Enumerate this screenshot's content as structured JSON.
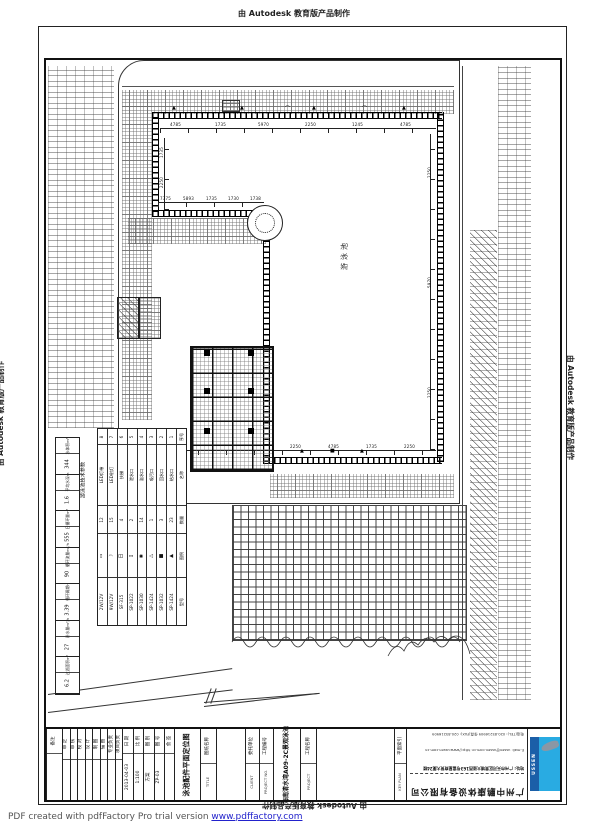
{
  "watermark": {
    "producer_top": "由 Autodesk 教育版产品制作",
    "producer_left": "由 Autodesk 教育版产品制作",
    "producer_right": "由 Autodesk 教育版产品制作",
    "producer_bottom": "由 Autodesk 教育版产品制作"
  },
  "footer": {
    "pdf_note": "PDF created with pdfFactory Pro trial version ",
    "pdf_link": "www.pdffactory.com"
  },
  "drawing": {
    "pool_label": "游泳池",
    "sym_triangle": "▲",
    "sym_square": "■",
    "sym_arc": "⌒",
    "top_dims": [
      "4785",
      "1735",
      "5970",
      "2250",
      "1245",
      "4785"
    ],
    "notch_dims": [
      "7375",
      "5893",
      "1735",
      "1730",
      "1738"
    ],
    "bottom_dims": [
      "2250",
      "4785",
      "1735",
      "2250"
    ],
    "left_dims": [
      "1735",
      "2250",
      "4785"
    ],
    "right_dims": [
      "2250",
      "5970",
      "2250"
    ]
  },
  "tech_table": {
    "title": "游泳池技术参数",
    "params": [
      {
        "label": "水体积m³",
        "value": "344"
      },
      {
        "label": "平均水深m",
        "value": "1.6"
      },
      {
        "label": "日循环量m³",
        "value": "555"
      },
      {
        "label": "循环流量m³/h",
        "value": "90"
      },
      {
        "label": "循环周期h",
        "value": "3.39"
      },
      {
        "label": "补水量m³/h",
        "value": "27"
      },
      {
        "label": "过滤面积m²",
        "value": "6.2"
      }
    ]
  },
  "legend": {
    "headers": {
      "no": "序号",
      "name": "名称",
      "qty": "数量",
      "symbol": "图例",
      "model": "型号"
    },
    "items": [
      {
        "no": "1",
        "name": "给水口",
        "qty": "23",
        "symbol": "▲",
        "model": "SP-1424"
      },
      {
        "no": "2",
        "name": "回水口",
        "qty": "3",
        "symbol": "■",
        "model": "SP-1032"
      },
      {
        "no": "3",
        "name": "吸污口",
        "qty": "1",
        "symbol": "△",
        "model": "SP-1424"
      },
      {
        "no": "4",
        "name": "溢水口",
        "qty": "14",
        "symbol": "◉",
        "model": "SP-1030"
      },
      {
        "no": "5",
        "name": "泄水口",
        "qty": "2",
        "symbol": "▯",
        "model": "SP-1022"
      },
      {
        "no": "6",
        "name": "扶梯",
        "qty": "4",
        "symbol": "日",
        "model": "SF-315"
      },
      {
        "no": "7",
        "name": "LED射灯",
        "qty": "15",
        "symbol": "☽",
        "model": "9W/12V"
      },
      {
        "no": "8",
        "name": "LED灯带",
        "qty": "12",
        "symbol": "▭",
        "model": "2W/12V"
      }
    ]
  },
  "title_block": {
    "note": "备注",
    "sign_cells": [
      "审 定",
      "审 核",
      "校 对",
      "设 计",
      "制 图",
      "描 图",
      "专业负责",
      "项目负责"
    ],
    "info_cells": [
      {
        "label": "日 期",
        "value": "2013-04-03"
      },
      {
        "label": "比 例",
        "value": "1:100"
      },
      {
        "label": "图 别",
        "value": "方案"
      },
      {
        "label": "图 号",
        "value": "ZP-03"
      },
      {
        "label": "会 签",
        "value": ""
      }
    ],
    "sheet_title": "泳池配件平面定位图",
    "sheet_title_label": {
      "label": "图纸名称",
      "sub": "TITLE"
    },
    "client": {
      "label": "委托单位",
      "sub": "CLIENT"
    },
    "project_no": {
      "label": "工程编号",
      "sub": "PROJECT NO."
    },
    "project_name": "海南清水湾A09-2C景观泳池",
    "project_label": {
      "label": "工程名称",
      "sub": "PROJECT"
    },
    "key_plan": {
      "label": "平面索引",
      "sub": "KEY PLAN"
    },
    "company": {
      "contact1": "电话(TEL): 020-85216909  传真(FAX): 020-85216909",
      "contact2": "E-mail: ussen@ussen.com.cn  http://www.ussen.com.cn",
      "address": "地址: 广州市天河区黄埔大道西163号富星商贸大厦24楼",
      "name": "广州中鹏康体设备有限公司"
    },
    "logo_text": "USSEN",
    "logo_dark": "#1b5fa8",
    "logo_light": "#29abe2"
  }
}
